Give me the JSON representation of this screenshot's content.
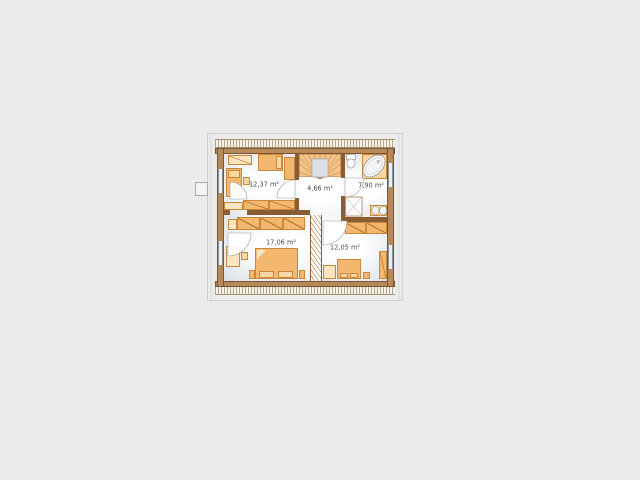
{
  "canvas": {
    "width": 640,
    "height": 480,
    "background": "#ebebeb"
  },
  "plan": {
    "name": "attic-floor-plan",
    "rooms": [
      {
        "name": "bedroom-top-left",
        "area_label": "12,37 m²"
      },
      {
        "name": "stair-hall",
        "area_label": "4,66 m²"
      },
      {
        "name": "bathroom",
        "area_label": "7,90 m²"
      },
      {
        "name": "bedroom-bottom-left",
        "area_label": "17,06 m²"
      },
      {
        "name": "bedroom-bottom-right",
        "area_label": "12,05 m²"
      }
    ],
    "colors": {
      "exterior_wall": "#b7895a",
      "interior_wall": "#8a5c34",
      "furniture": "#f3b76f",
      "furniture_light": "#f9d6a2",
      "floor_shade": "#dfe3e8",
      "roof_hatch": "#b3a48c",
      "label_text": "#4d4d4d"
    }
  }
}
